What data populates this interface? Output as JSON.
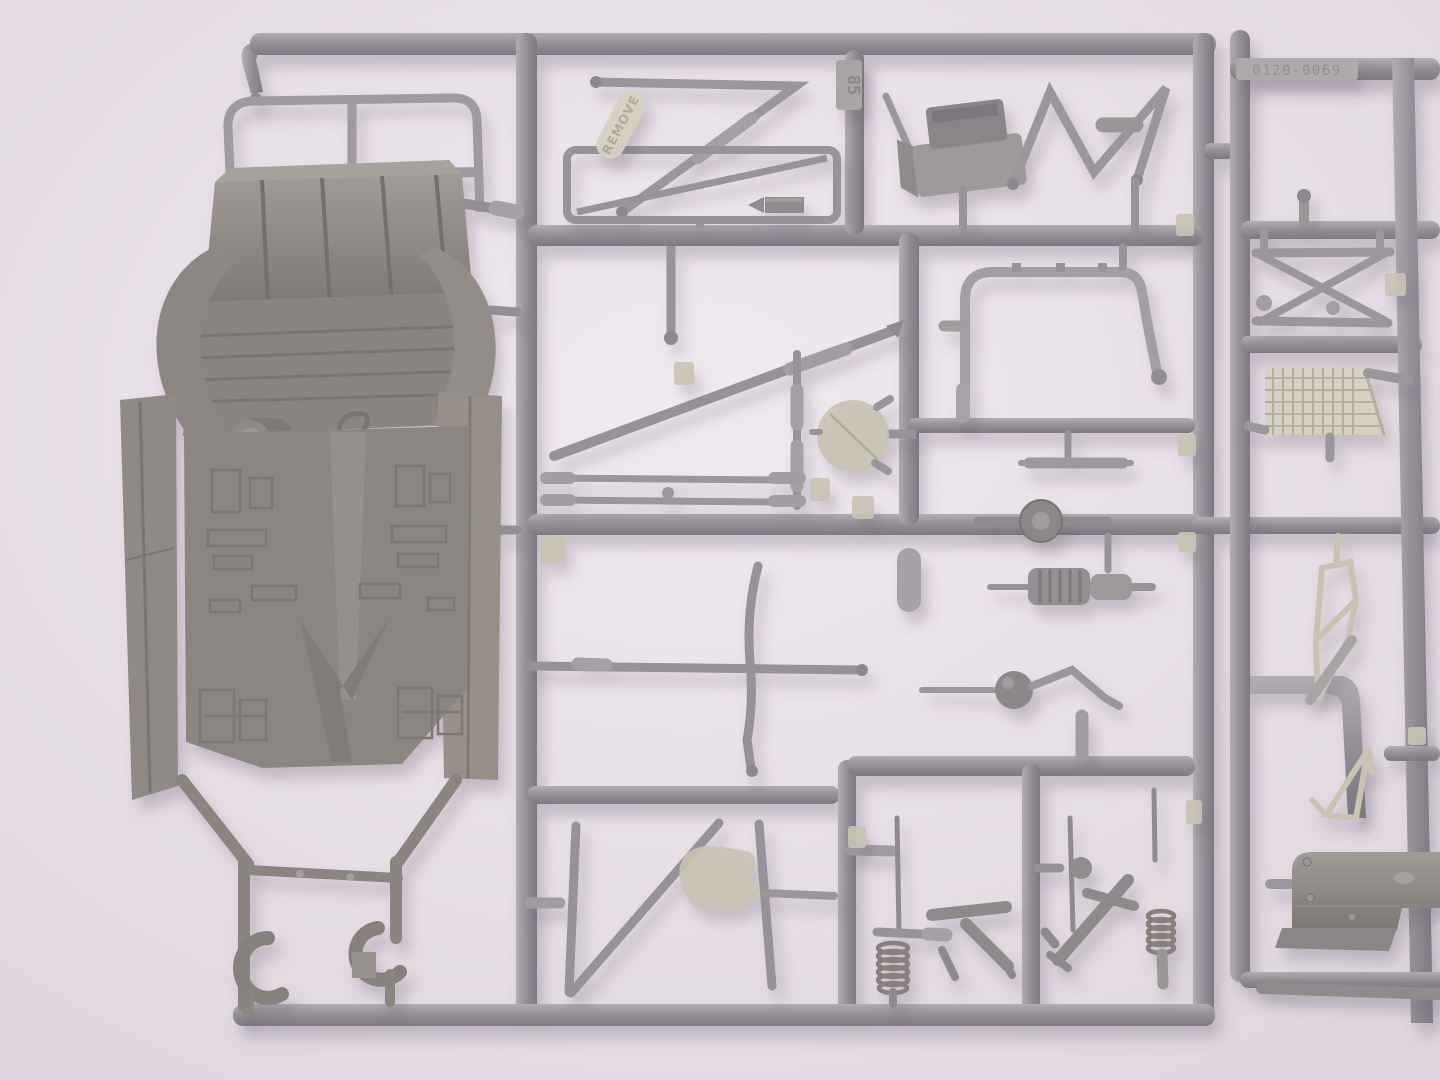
{
  "scene": {
    "description": "Photograph of grey injection-molded plastic model kit sprues (parts trees) for a scale vehicle kit, lying on a pale pink-white surface. A large chassis body part is attached at the left; the runners frame many small parts: tubes, a roll bar, coil springs, suspension arms, a mesh grille and a tank panel.",
    "palette": {
      "background_top": "#f1ebf1",
      "background_bottom": "#e3dae2",
      "vignette_edge": "#ddd4dc",
      "runner_light": "#b2adb3",
      "runner_mid": "#969198",
      "runner_dark": "#7e7980",
      "part_grey": "#98939a",
      "part_grey_light": "#aba6ac",
      "part_grey_dark": "#827d83",
      "chassis_base": "#8e8885",
      "chassis_dark": "#7a7471",
      "chassis_light": "#a39d98",
      "translucent_beige": "#c9c3b4",
      "translucent_beige_light": "#d7d1c2",
      "translucent_beige_dark": "#b1aa99",
      "knob_dark": "#8a8589"
    }
  },
  "markings": {
    "remove_tag": "REMOVE",
    "sprue_gate_number": "85",
    "mold_number": "0120-0069"
  }
}
